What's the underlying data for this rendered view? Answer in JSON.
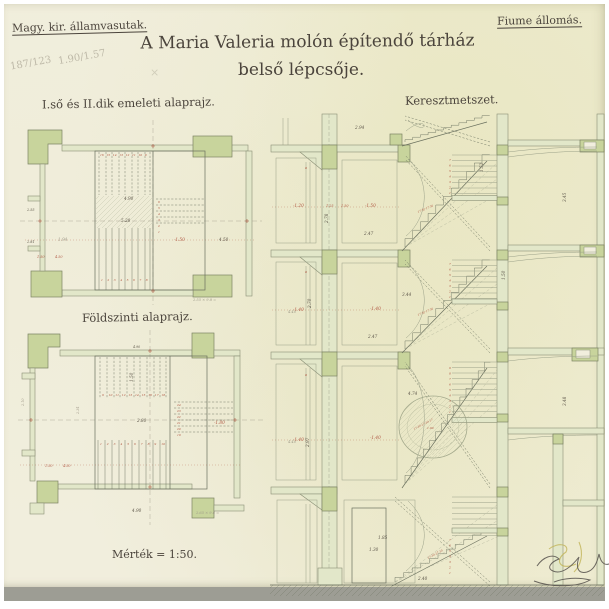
{
  "document": {
    "agency": "Magy. kir. államvasutak.",
    "station": "Fiume állomás.",
    "title_line1": "A Maria Valeria molón építendő tárház",
    "title_line2": "belső lépcsője.",
    "scale_note": "Mérték = 1:50.",
    "labels": {
      "upper_plan": "I.ső és II.dik emeleti alaprajz.",
      "ground_plan": "Földszinti alaprajz.",
      "section": "Keresztmetszet."
    },
    "pencil_notes": {
      "fraction_1": "187/123",
      "fraction_2": "1.90/1.57",
      "mark": "×",
      "calc_upper": "2.55 × 9.8 =",
      "calc_ground": "2.65 × 9.6 ="
    }
  },
  "colors": {
    "paper": "#f1eedd",
    "ink": "#6a705e",
    "ink_light": "#9aa088",
    "line": "#8a9076",
    "line_dark": "#7c8464",
    "green": "#c8d49c",
    "green_light": "#e2e7c9",
    "red": "#b05742",
    "pencil": "#a39e8d",
    "text": "#4b443c"
  },
  "drawings": {
    "dims": {
      "plan_upper": [
        {
          "x": 124,
          "y": 200,
          "t": "4.90"
        },
        {
          "x": 121,
          "y": 222,
          "t": "5.28"
        },
        {
          "x": 58,
          "y": 241,
          "t": "1.94",
          "c": "pencil"
        },
        {
          "x": 174,
          "y": 241,
          "t": "-1.50",
          "c": "red"
        },
        {
          "x": 219,
          "y": 241,
          "t": "4.50"
        },
        {
          "x": 27,
          "y": 211,
          "t": "2.55",
          "s": 3.4
        },
        {
          "x": 27,
          "y": 243,
          "t": "2.81",
          "s": 3.4
        },
        {
          "x": 37,
          "y": 258,
          "t": "1.50",
          "c": "red",
          "s": 3.4
        },
        {
          "x": 55,
          "y": 258,
          "t": "4.50",
          "c": "red",
          "s": 3.4
        },
        {
          "x": 193,
          "y": 301,
          "t": "2.55 × 9.8 =",
          "c": "pencil",
          "s": 3.6
        }
      ],
      "plan_ground": [
        {
          "x": 133,
          "y": 382,
          "t": "1.50",
          "r": -90
        },
        {
          "x": 137,
          "y": 422,
          "t": "2.80"
        },
        {
          "x": 214,
          "y": 424,
          "t": "-1.80",
          "c": "red"
        },
        {
          "x": 132,
          "y": 512,
          "t": "4.90"
        },
        {
          "x": 133,
          "y": 348,
          "t": "4.90",
          "s": 3.2
        },
        {
          "x": 196,
          "y": 514,
          "t": "2.65 × 9.6 =",
          "c": "pencil",
          "s": 3.6
        },
        {
          "x": 79,
          "y": 414,
          "t": "2.34",
          "r": -90,
          "c": "pencil",
          "s": 3.4
        },
        {
          "x": 24,
          "y": 406,
          "t": "2.10",
          "r": -90,
          "c": "pencil",
          "s": 3.4
        },
        {
          "x": 45,
          "y": 467,
          "t": "1.50",
          "c": "red",
          "s": 3.4
        },
        {
          "x": 63,
          "y": 467,
          "t": "4.50",
          "c": "red",
          "s": 3.4
        }
      ],
      "section": [
        {
          "x": 355,
          "y": 129,
          "t": "2.94"
        },
        {
          "x": 311,
          "y": 308,
          "t": "2.70",
          "r": -90
        },
        {
          "x": 328,
          "y": 223,
          "t": "2.78",
          "r": -90
        },
        {
          "x": 364,
          "y": 235,
          "t": "2.47"
        },
        {
          "x": 368,
          "y": 338,
          "t": "2.47"
        },
        {
          "x": 402,
          "y": 296,
          "t": "3.44"
        },
        {
          "x": 408,
          "y": 395,
          "t": "4.74"
        },
        {
          "x": 309,
          "y": 447,
          "t": "2.97",
          "r": -90
        },
        {
          "x": 378,
          "y": 539,
          "t": "1.85"
        },
        {
          "x": 369,
          "y": 551,
          "t": "1.30"
        },
        {
          "x": 418,
          "y": 580,
          "t": "2.40"
        },
        {
          "x": 566,
          "y": 202,
          "t": "3.45",
          "r": -90
        },
        {
          "x": 566,
          "y": 406,
          "t": "3.48",
          "r": -90
        },
        {
          "x": 483,
          "y": 172,
          "t": "1.52",
          "r": -90
        },
        {
          "x": 505,
          "y": 280,
          "t": "1.50",
          "r": -90
        },
        {
          "x": 293,
          "y": 207,
          "t": "-1.20",
          "c": "red"
        },
        {
          "x": 326,
          "y": 207,
          "t": "1.25",
          "c": "red",
          "s": 3.4
        },
        {
          "x": 341,
          "y": 207,
          "t": "1.50",
          "c": "red",
          "s": 3.4
        },
        {
          "x": 365,
          "y": 207,
          "t": "-1.50",
          "c": "red"
        },
        {
          "x": 293,
          "y": 311,
          "t": "-1.40",
          "c": "red"
        },
        {
          "x": 370,
          "y": 310,
          "t": "-1.40",
          "c": "red"
        },
        {
          "x": 293,
          "y": 441,
          "t": "-1.40",
          "c": "red"
        },
        {
          "x": 370,
          "y": 439,
          "t": "-1.40",
          "c": "red"
        },
        {
          "x": 305,
          "y": 169,
          "t": "a",
          "c": "red",
          "s": 3.4
        },
        {
          "x": 305,
          "y": 273,
          "t": "a",
          "c": "red",
          "s": 3.4
        },
        {
          "x": 305,
          "y": 376,
          "t": "a",
          "c": "red",
          "s": 3.4
        },
        {
          "x": 288,
          "y": 313,
          "t": "4.40",
          "c": "pencil",
          "s": 3.6
        },
        {
          "x": 288,
          "y": 443,
          "t": "4.40",
          "c": "pencil",
          "s": 3.6
        },
        {
          "x": 418,
          "y": 213,
          "t": "17·30·17·30",
          "r": -23,
          "c": "red",
          "s": 2.8
        },
        {
          "x": 418,
          "y": 316,
          "t": "17·30·17·30",
          "r": -23,
          "c": "red",
          "s": 2.8
        },
        {
          "x": 414,
          "y": 430,
          "t": "17·30·17·30·17",
          "r": -27,
          "c": "red",
          "s": 2.8
        },
        {
          "x": 428,
          "y": 559,
          "t": "17·30·17·30",
          "r": -28,
          "c": "red",
          "s": 2.8
        },
        {
          "x": 427,
          "y": 429,
          "t": "1.90",
          "c": "red",
          "s": 3
        }
      ]
    },
    "digit_rows": [
      {
        "g": "dims-plan-upper",
        "x": 100,
        "y": 156,
        "dx": 6.4,
        "dy": 0,
        "vals": [
          "16",
          "15",
          "14",
          "13",
          "12",
          "11",
          "10",
          "9"
        ]
      },
      {
        "g": "dims-plan-upper",
        "x": 158,
        "y": 203,
        "dx": 0,
        "dy": 6,
        "vals": [
          "6",
          "5",
          "4",
          "3",
          "2",
          "1"
        ]
      },
      {
        "g": "dims-plan-upper",
        "x": 101,
        "y": 281,
        "dx": 6.4,
        "dy": 0,
        "vals": [
          "1",
          "2",
          "3",
          "4",
          "5",
          "6",
          "7",
          "8"
        ]
      },
      {
        "g": "dims-plan-ground",
        "x": 102,
        "y": 396,
        "dx": 6.6,
        "dy": 0,
        "vals": [
          "9",
          "10",
          "11",
          "12",
          "13",
          "14",
          "15",
          "16",
          "17",
          "18"
        ]
      },
      {
        "g": "dims-plan-ground",
        "x": 177,
        "y": 406,
        "dx": 0,
        "dy": 6,
        "vals": [
          "24",
          "23",
          "22",
          "21",
          "20",
          "19"
        ]
      },
      {
        "g": "dims-plan-ground",
        "x": 100,
        "y": 445,
        "dx": 6.8,
        "dy": 0,
        "vals": [
          "1",
          "2",
          "3",
          "4",
          "5",
          "6",
          "7",
          "8",
          "9",
          "10"
        ]
      },
      {
        "g": "dims-section",
        "x": 449,
        "y": 161,
        "dx": 0,
        "dy": 5.5,
        "vals": [
          "7",
          "6",
          "5",
          "4",
          "3",
          "2",
          "1"
        ]
      },
      {
        "g": "dims-section",
        "x": 449,
        "y": 265,
        "dx": 0,
        "dy": 5.5,
        "vals": [
          "7",
          "6",
          "5",
          "4",
          "3",
          "2",
          "1"
        ]
      },
      {
        "g": "dims-section",
        "x": 449,
        "y": 369,
        "dx": 0,
        "dy": 5.5,
        "vals": [
          "9",
          "8",
          "7",
          "6",
          "5",
          "4",
          "3",
          "2",
          "1"
        ]
      },
      {
        "g": "dims-section",
        "x": 449,
        "y": 541,
        "dx": 0,
        "dy": 5.5,
        "vals": [
          "7",
          "6",
          "5",
          "4",
          "3",
          "2",
          "1"
        ]
      }
    ]
  }
}
